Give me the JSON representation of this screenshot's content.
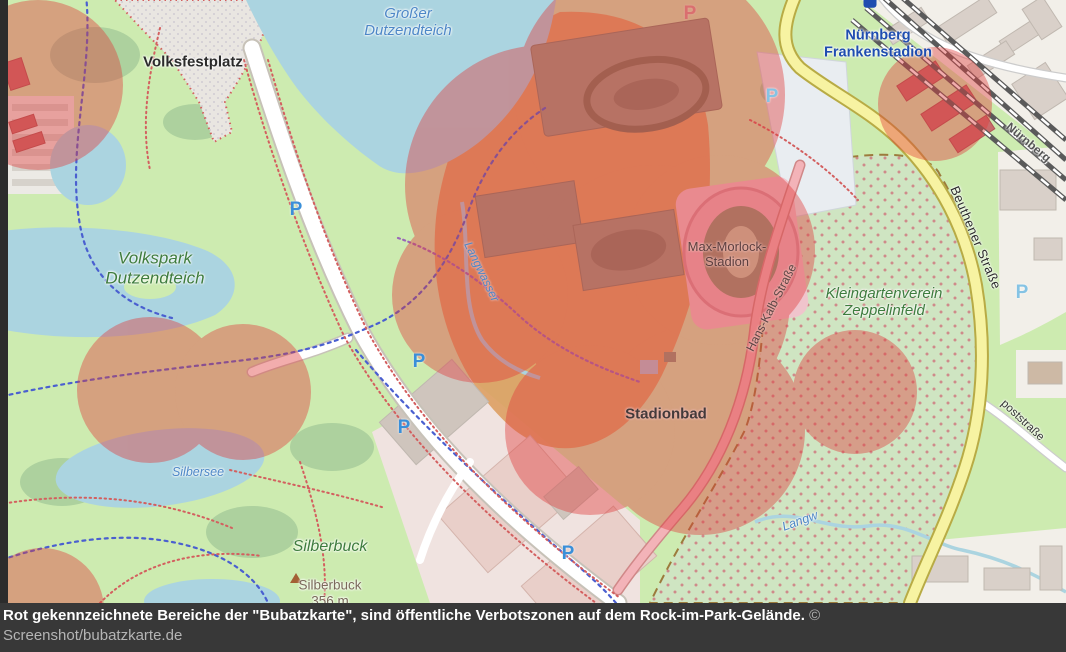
{
  "caption": {
    "text": "Rot gekennzeichnete Bereiche der \"Bubatzkarte\", sind öffentliche Verbotszonen auf dem Rock-im-Park-Gelände.",
    "credit": "© Screenshot/bubatzkarte.de"
  },
  "map": {
    "parking_symbol": "P",
    "labels": {
      "volksfestplatz": {
        "text": "Volksfestplatz"
      },
      "grosser_dutzendteich": {
        "line1": "Großer",
        "line2": "Dutzendteich"
      },
      "frankenstadion": {
        "line1": "Nürnberg",
        "line2": "Frankenstadion"
      },
      "volkspark": {
        "line1": "Volkspark",
        "line2": "Dutzendteich"
      },
      "silbersee": {
        "text": "Silbersee"
      },
      "silberbuck_hill": {
        "text": "Silberbuck"
      },
      "silberbuck_peak": {
        "name": "Silberbuck",
        "elevation": "356 m"
      },
      "max_morlock_stadion": {
        "line1": "Max-Morlock-",
        "line2": "Stadion"
      },
      "stadionbad": {
        "text": "Stadionbad"
      },
      "kleingartenverein": {
        "line1": "Kleingartenverein",
        "line2": "Zeppelinfeld"
      },
      "beuthener_strasse": {
        "text": "Beuthener Straße"
      },
      "hans_kalb_strasse": {
        "text": "Hans-Kalb-Straße"
      },
      "langwasser_stream": {
        "text": "Langwasser"
      },
      "langwasser_stream_short": {
        "text": "Langw"
      },
      "poststrasse": {
        "text": "poststraße"
      },
      "railway_nuernberg": {
        "text": "Nürnberg"
      }
    }
  },
  "theme": {
    "red-zone": "#e03c3c",
    "water": "#abd4e0",
    "park-green": "#cdebb0",
    "forest-green": "#add19e",
    "allotment-green": "#cfe5c2",
    "festival-orange": "#dd9e63",
    "road-yellow": "#f7f3a2",
    "pitch-olive": "#9a9a82",
    "land-beige": "#f2efe9",
    "building-grey": "#d9d0c9",
    "caption-bg": "#383838",
    "caption-text": "#ffffff",
    "caption-credit": "#b5b5b5",
    "label-water-blue": "#4d87c7",
    "label-green": "#3e7c3e",
    "station-blue": "#1f4db0",
    "parking-blue": "#3a8fd9"
  }
}
